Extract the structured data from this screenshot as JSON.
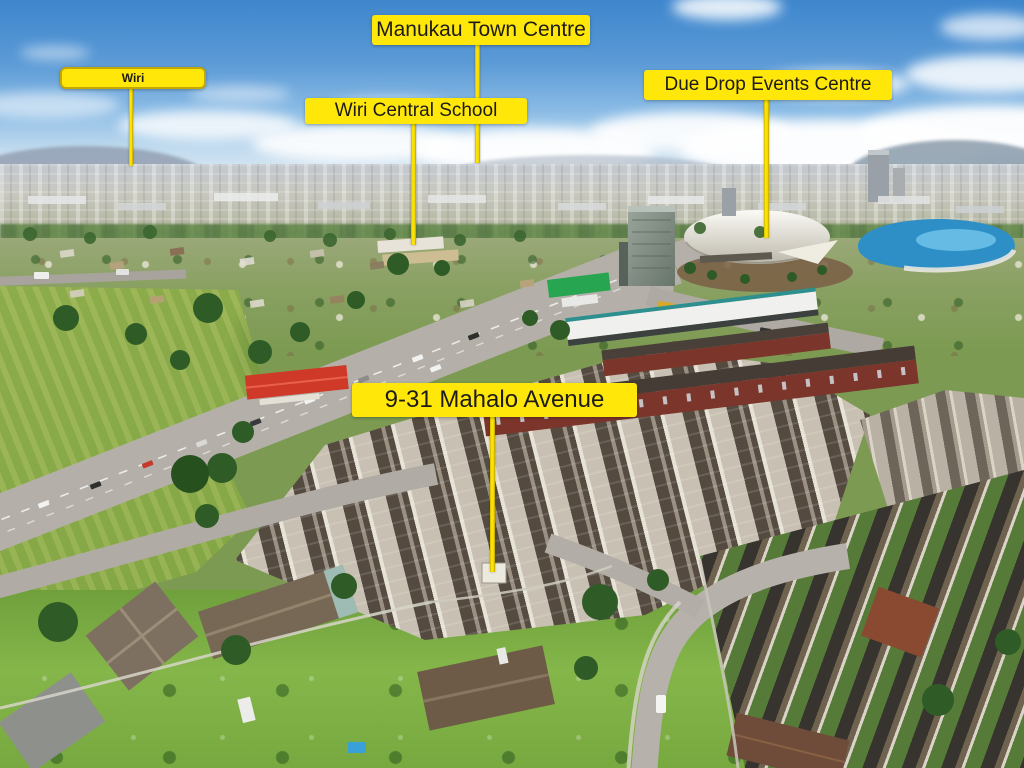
{
  "labels": {
    "wiri": "Wiri",
    "manukau_town_centre": "Manukau Town Centre",
    "wiri_central_school": "Wiri Central School",
    "due_drop_events_centre": "Due Drop Events Centre",
    "property_address": "9-31 Mahalo Avenue"
  },
  "colors": {
    "label_background": "#FFE70A",
    "label_text": "#1D1B17",
    "pointer_line": "#F2DC00",
    "wiri_label_border": "#C3A800",
    "sky": "#3E86CD",
    "grass_field": "#86A845",
    "wave_pool_water": "#2E8FC7",
    "road": "#B4B0A9"
  }
}
